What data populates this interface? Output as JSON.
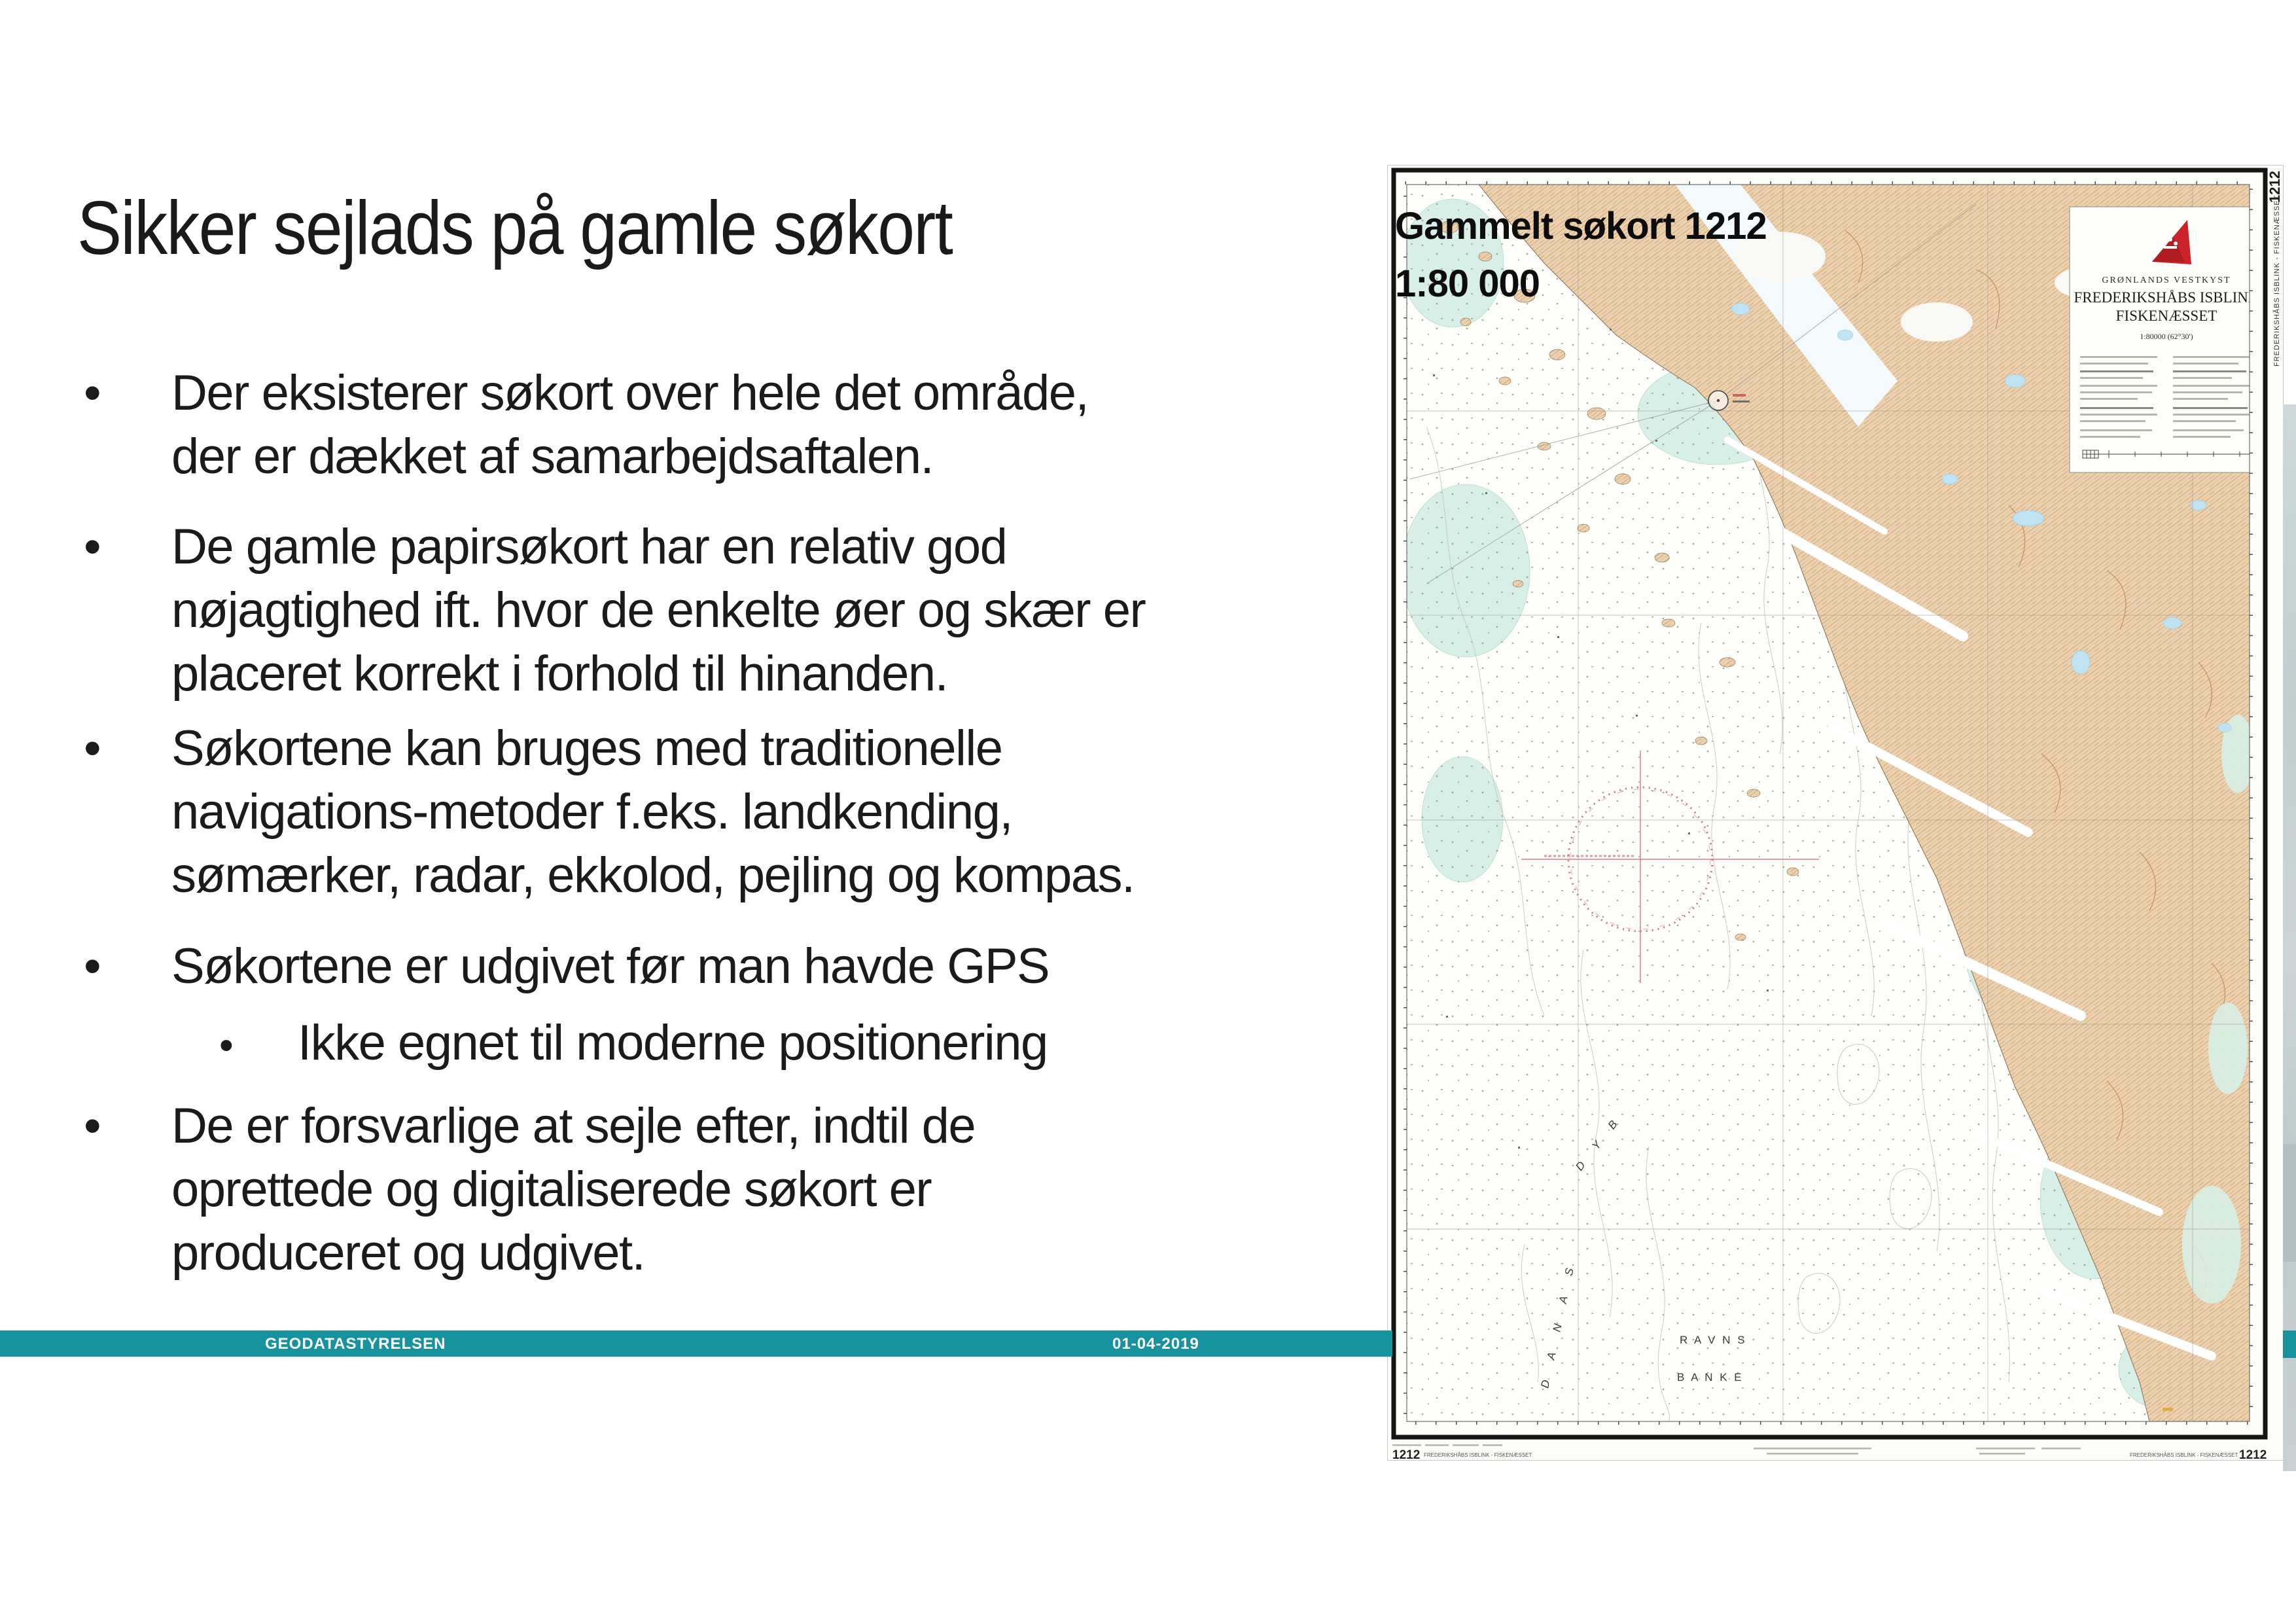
{
  "slide": {
    "title": "Sikker sejlads på gamle søkort",
    "bullets": [
      {
        "level": 1,
        "lines": [
          "Der eksisterer søkort over hele det område,",
          "der er dækket af samarbejdsaftalen."
        ]
      },
      {
        "level": 1,
        "lines": [
          "De gamle papirsøkort har en relativ god",
          "nøjagtighed ift. hvor de enkelte øer og skær er",
          "placeret korrekt i forhold til hinanden."
        ]
      },
      {
        "level": 1,
        "lines": [
          "Søkortene kan bruges med traditionelle",
          "navigations-metoder f.eks. landkending,",
          "sømærker, radar, ekkolod, pejling og kompas."
        ]
      },
      {
        "level": 1,
        "lines": [
          "Søkortene er udgivet før man havde GPS"
        ]
      },
      {
        "level": 2,
        "lines": [
          "Ikke egnet til moderne positionering"
        ]
      },
      {
        "level": 1,
        "lines": [
          "De er forsvarlige at sejle efter, indtil de",
          "oprettede og digitaliserede søkort er",
          "produceret og udgivet."
        ]
      }
    ]
  },
  "footer": {
    "org": "GEODATASTYRELSEN",
    "date": "01-04-2019",
    "bar_color": "#17929f"
  },
  "map_overlay": {
    "line1": "Gammelt søkort 1212",
    "line2": "1:80 000"
  },
  "chart": {
    "number": "1212",
    "region": "GRØNLANDS VESTKYST",
    "title1": "FREDERIKSHÅBS ISBLINK",
    "title2": "FISKENÆSSET",
    "scale": "1:80000 (62°30')",
    "side_label": "FREDERIKSHÅBS ISBLINK - FISKENÆSSET",
    "imprint_name": "FREDERIKSHÅBS ISBLINK - FISKENÆSSET",
    "sea": {
      "danas": "D A N A S",
      "dyb": "D Y B",
      "ravns": "R A V N S",
      "banke": "B A N K E"
    },
    "colors": {
      "land": "#ecd2b0",
      "shallow_water": "#d8efe7",
      "lake": "#bfe3f2",
      "warning_red": "#d4707f",
      "flag_red": "#cc2229"
    }
  }
}
